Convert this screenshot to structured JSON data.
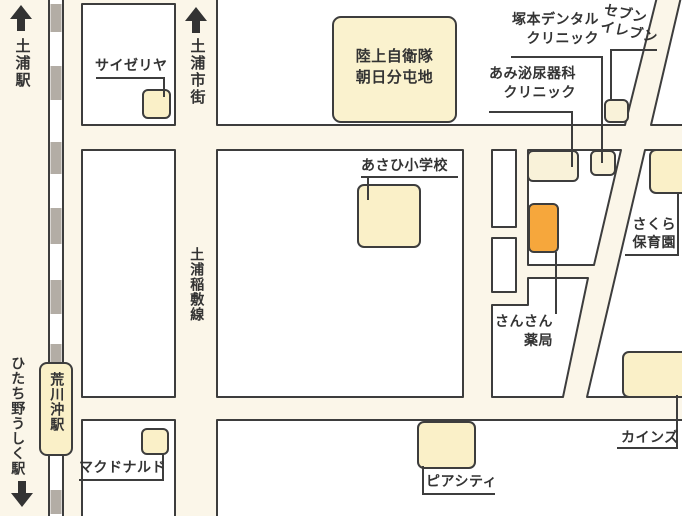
{
  "stations": {
    "tsuchiura": "土浦駅",
    "hitachino_ushiku": "ひたち野うしく駅",
    "arakawaoki": "荒川沖駅"
  },
  "roads": {
    "to_tsuchiura_city": "土浦市街",
    "tsuchiura_inashiki_line": "土浦稲敷線"
  },
  "places": {
    "saizeriya": "サイゼリヤ",
    "jsdf_line1": "陸上自衛隊",
    "jsdf_line2": "朝日分屯地",
    "tsukamoto_line1": "塚本デンタル",
    "tsukamoto_line2": "クリニック",
    "seveneleven_line1": "セブン",
    "seveneleven_line2": "イレブン",
    "ami_line1": "あみ泌尿器科",
    "ami_line2": "クリニック",
    "asahi_school": "あさひ小学校",
    "sakura_line1": "さくら",
    "sakura_line2": "保育園",
    "sansan_line1": "さんさん",
    "sansan_line2": "薬局",
    "mcdonalds": "マクドナルド",
    "piacity": "ピアシティ",
    "cainz": "カインズ"
  },
  "highlight": {
    "name": "さんさん薬局",
    "color": "#F6A73C"
  },
  "colors": {
    "road_background": "#FBF6E9",
    "block_fill": "#FFFFFF",
    "building_fill": "#FAF0C8",
    "building_fill_light": "#F9F2D9",
    "outline": "#3D3D3D",
    "railway_gray": "#B3ADA5",
    "text": "#333333"
  }
}
